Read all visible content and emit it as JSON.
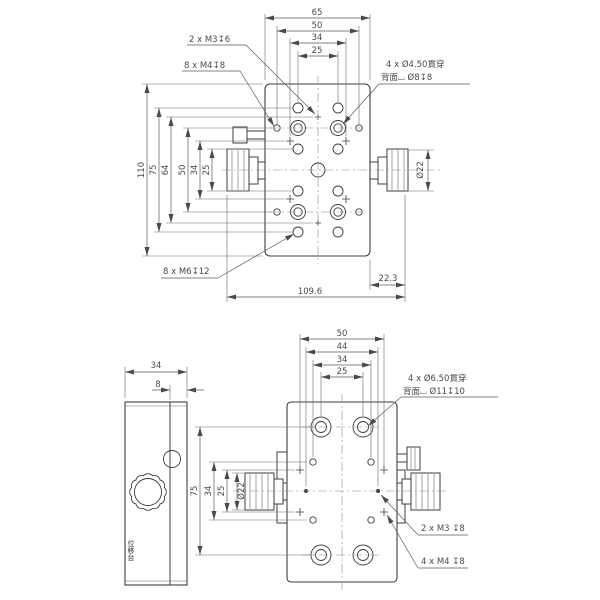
{
  "page": {
    "background": "#ffffff",
    "line_color": "#3c3c3c",
    "drawing_type": "2-axis translation stage dimensional drawing"
  },
  "top_view": {
    "dim_top": [
      "65",
      "50",
      "34",
      "25"
    ],
    "dim_left": [
      "110",
      "75",
      "64",
      "50",
      "34",
      "25"
    ],
    "dim_knob_dia": "Ø22",
    "dim_offset": "22.3",
    "dim_overall": "109.6",
    "label_m3": "2 x M3↧6",
    "label_m4": "8 x M4↧8",
    "label_cbore_line1": "4 x Ø4.50貫穿",
    "label_cbore_line2": "背面⌴ Ø8↧8",
    "label_m6": "8 x M6↧12"
  },
  "front_view": {
    "dim_top": [
      "50",
      "44",
      "34",
      "25"
    ],
    "dim_left": [
      "75",
      "34",
      "25"
    ],
    "dim_knob_dia": "Ø22",
    "label_cbore_line1": "4 x Ø6.50貫穿",
    "label_cbore_line2": "背面⌴ Ø11↧10",
    "label_m3": "2 x M3 ↧8",
    "label_m4": "4 x M4 ↧8"
  },
  "side_view": {
    "dim_width": "34",
    "dim_face": "8",
    "brand": "位移台"
  }
}
